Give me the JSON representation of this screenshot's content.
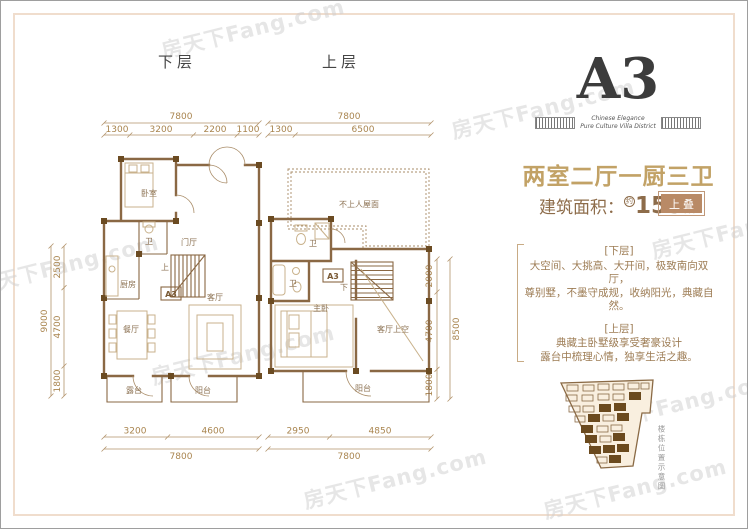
{
  "watermark": {
    "text": "房天下Fang.com"
  },
  "plans": {
    "lower": {
      "title": "下层",
      "dim_top_total": "7800",
      "dims_top": [
        "1300",
        "3200",
        "2200",
        "1100"
      ],
      "dim_left_total": "9000",
      "dims_left": [
        "2500",
        "4700",
        "1800"
      ],
      "dims_bottom": [
        "3200",
        "4600"
      ],
      "dim_bottom_total": "7800",
      "unit_label": "A3",
      "stair_label": "上",
      "rooms": {
        "bedroom": "卧室",
        "bath": "卫",
        "foyer": "门厅",
        "kitchen": "厨房",
        "dining": "餐厅",
        "living": "客厅",
        "terrace": "露台",
        "balcony": "阳台"
      }
    },
    "upper": {
      "title": "上层",
      "dim_top_total": "7800",
      "dims_top": [
        "1300",
        "6500"
      ],
      "dim_right_total": "8500",
      "dims_right": [
        "2000",
        "4700",
        "1800"
      ],
      "dims_bottom": [
        "2950",
        "4850"
      ],
      "dim_bottom_total": "7800",
      "unit_label": "A3",
      "stair_label": "下",
      "rooms": {
        "roof": "不上人屋面",
        "bath1": "卫",
        "bath2": "卫",
        "master": "主卧",
        "void": "客厅上空",
        "balcony": "阳台"
      }
    }
  },
  "info": {
    "unit_name": "A3",
    "tagline_line1": "Chinese Elegance",
    "tagline_line2": "Pure Culture Villa District",
    "layout_title": "两室二厅一厨三卫",
    "area_label": "建筑面积：",
    "area_approx": "约",
    "area_value": "153",
    "area_unit": "㎡",
    "badge": "上叠",
    "desc_lower_title": "[下层]",
    "desc_lower_line1": "大空间、大挑高、大开间，极致南向双厅，",
    "desc_lower_line2": "尊别墅，不墨守成规，收纳阳光，典藏自然。",
    "desc_upper_title": "[上层]",
    "desc_upper_line1": "典藏主卧墅级享受奢豪设计",
    "desc_upper_line2": "露台中梳理心情，独享生活之趣。",
    "siteplan_caption": "楼栋位置示意图"
  },
  "colors": {
    "accent_gold": "#c2a266",
    "brown_text": "#8d6c4a",
    "badge_brown": "#b98a66",
    "wall_brown": "#8a6844"
  }
}
